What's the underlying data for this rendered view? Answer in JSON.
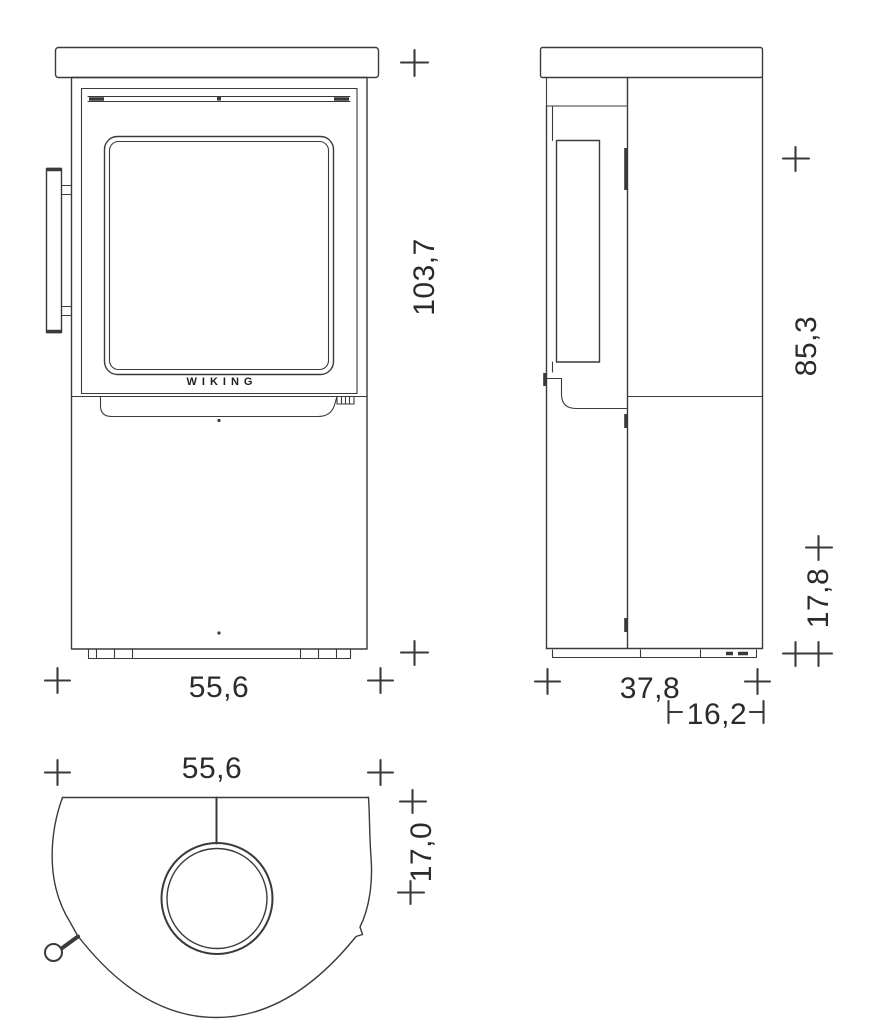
{
  "brand": {
    "label": "WIKING"
  },
  "views": {
    "front": {
      "name": "front view",
      "dim_height": "103,7",
      "dim_width": "55,6"
    },
    "side": {
      "name": "side view",
      "dim_height": "85,3",
      "dim_lower_height": "17,8",
      "dim_depth": "37,8",
      "dim_flue_offset": "16,2"
    },
    "top": {
      "name": "top view",
      "dim_width": "55,6",
      "dim_flue_center": "17,0"
    }
  },
  "colors": {
    "line": "#3a3a3a",
    "background": "#ffffff"
  }
}
